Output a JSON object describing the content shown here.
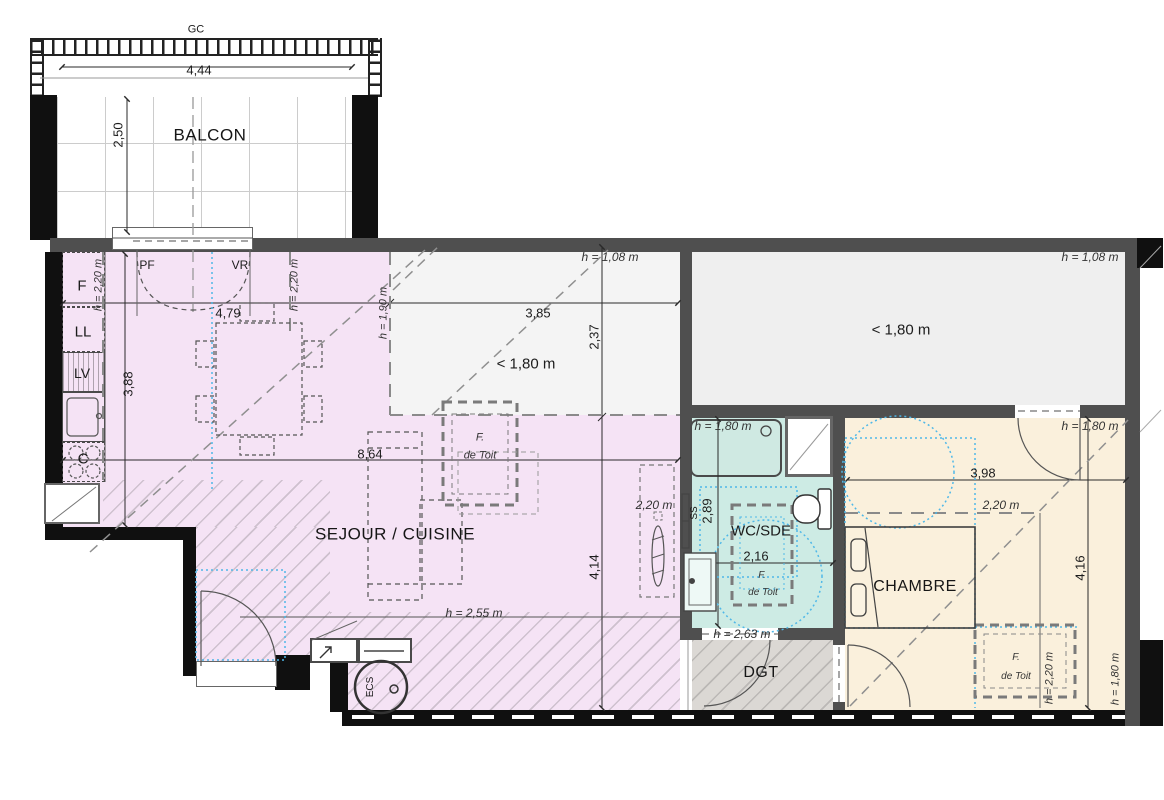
{
  "rooms": {
    "balcon": "BALCON",
    "sejour": "SEJOUR / CUISINE",
    "wc": "WC/SDE",
    "chambre": "CHAMBRE",
    "dgt": "DGT"
  },
  "zones": {
    "low_mid": "< 1,80 m",
    "low_right": "< 1,80 m"
  },
  "kitchen": {
    "fridge": "F",
    "washing_machine": "LL",
    "dishwasher": "LV",
    "cooktop": "C"
  },
  "equipment": {
    "water_heater": "ECS",
    "towel_rail": "SS"
  },
  "openings": {
    "gc": "GC",
    "pf": "PF",
    "vr": "VR"
  },
  "roof_window": {
    "l1": "F.",
    "l2": "de Toit"
  },
  "dims": {
    "d444": "4,44",
    "d250": "2,50",
    "d479": "4,79",
    "d388": "3,88",
    "d385": "3,85",
    "d237": "2,37",
    "d864": "8,64",
    "d414": "4,14",
    "d289": "2,89",
    "d216": "2,16",
    "d398": "3,98",
    "d416": "4,16"
  },
  "heights": {
    "k_left": "h = 2,20 m",
    "k_right": "h = 2,20 m",
    "living_190": "h = 1,90 m",
    "mid_108": "h = 1,08 m",
    "right_108": "h = 1,08 m",
    "living_255": "h = 2,55 m",
    "wc_180": "h = 1,80 m",
    "wc_263": "h = 2,63 m",
    "bed_door_180": "h = 1,80 m",
    "bed_220_line": "2,20 m",
    "bed_roof_220": "h = 2,20 m",
    "bed_right_180": "h = 1,80 m",
    "radiator_220": "2,20 m"
  },
  "colors": {
    "living": "#f5e3f5",
    "bathroom": "#cdebe4",
    "bedroom": "#faf0dc",
    "hall": "#dbd8d4",
    "low_zone": "#f4f4f4",
    "wall": "#4f4f4f",
    "wall_black": "#101010",
    "accessibility": "#4fb8e8"
  }
}
